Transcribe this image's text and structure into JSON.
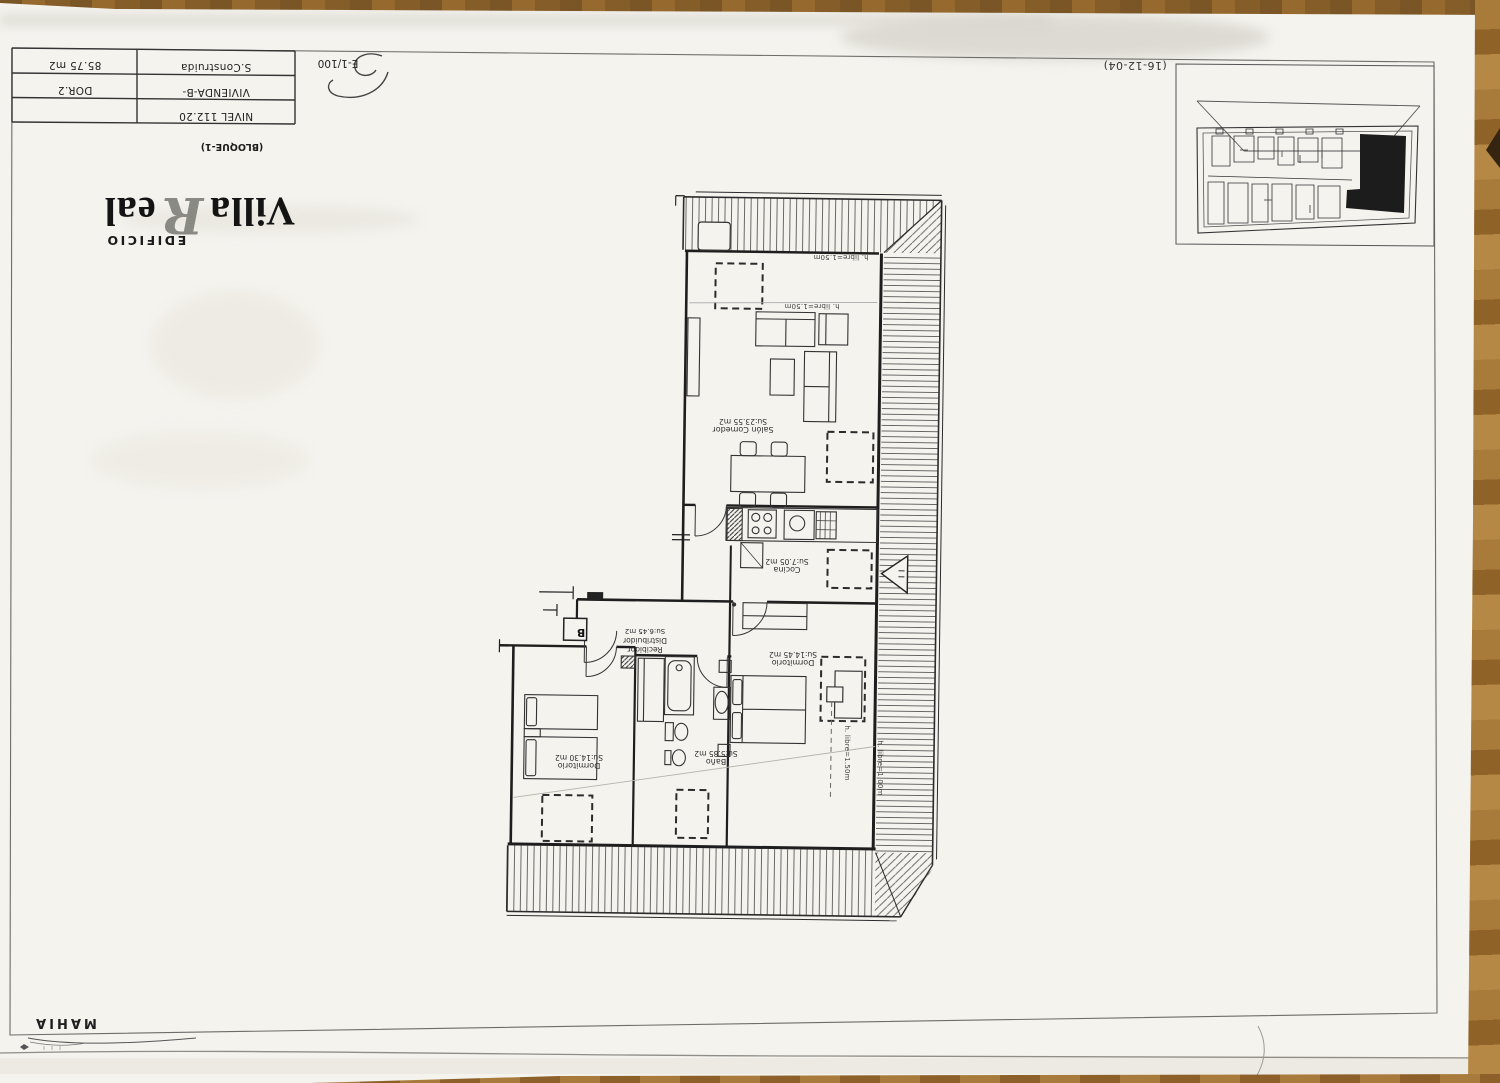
{
  "sheet": {
    "date_note": "(16-12-04)",
    "author": "MAHIA",
    "title_block": {
      "rows": [
        {
          "c1": "85.75 m2",
          "c2": "S.Construida"
        },
        {
          "c1": "DOR.2",
          "c2": "VIVIENDA-B-"
        },
        {
          "c1": "",
          "c2": "NIVEL 112.20"
        }
      ],
      "scale": "E-1/100",
      "block_note": "(BLOQUE-1)",
      "logo": {
        "edificio": "EDIFICIO",
        "villa": "Villa",
        "r": "R",
        "eal": "eal"
      }
    }
  },
  "plan": {
    "entrance_label": "B",
    "rooms": [
      {
        "id": "salon",
        "name": "Salón Comedor",
        "area": "Su:23.55 m2"
      },
      {
        "id": "cocina",
        "name": "Cocina",
        "area": "Su:7.05 m2"
      },
      {
        "id": "dormitorio1",
        "name": "Dormitorio",
        "area": "Su:14.45 m2"
      },
      {
        "id": "recibidor",
        "name": "Recibidor",
        "name2": "Distribuidor",
        "area": "Su:6.45 m2"
      },
      {
        "id": "bano",
        "name": "Baño",
        "area": "Su:5.85 m2"
      },
      {
        "id": "dormitorio2",
        "name": "Dormitorio",
        "area": "Su:14.30 m2"
      }
    ],
    "height_notes": {
      "h150": "h. libre=1.50m",
      "h100": "h. libre=1.00m"
    }
  }
}
